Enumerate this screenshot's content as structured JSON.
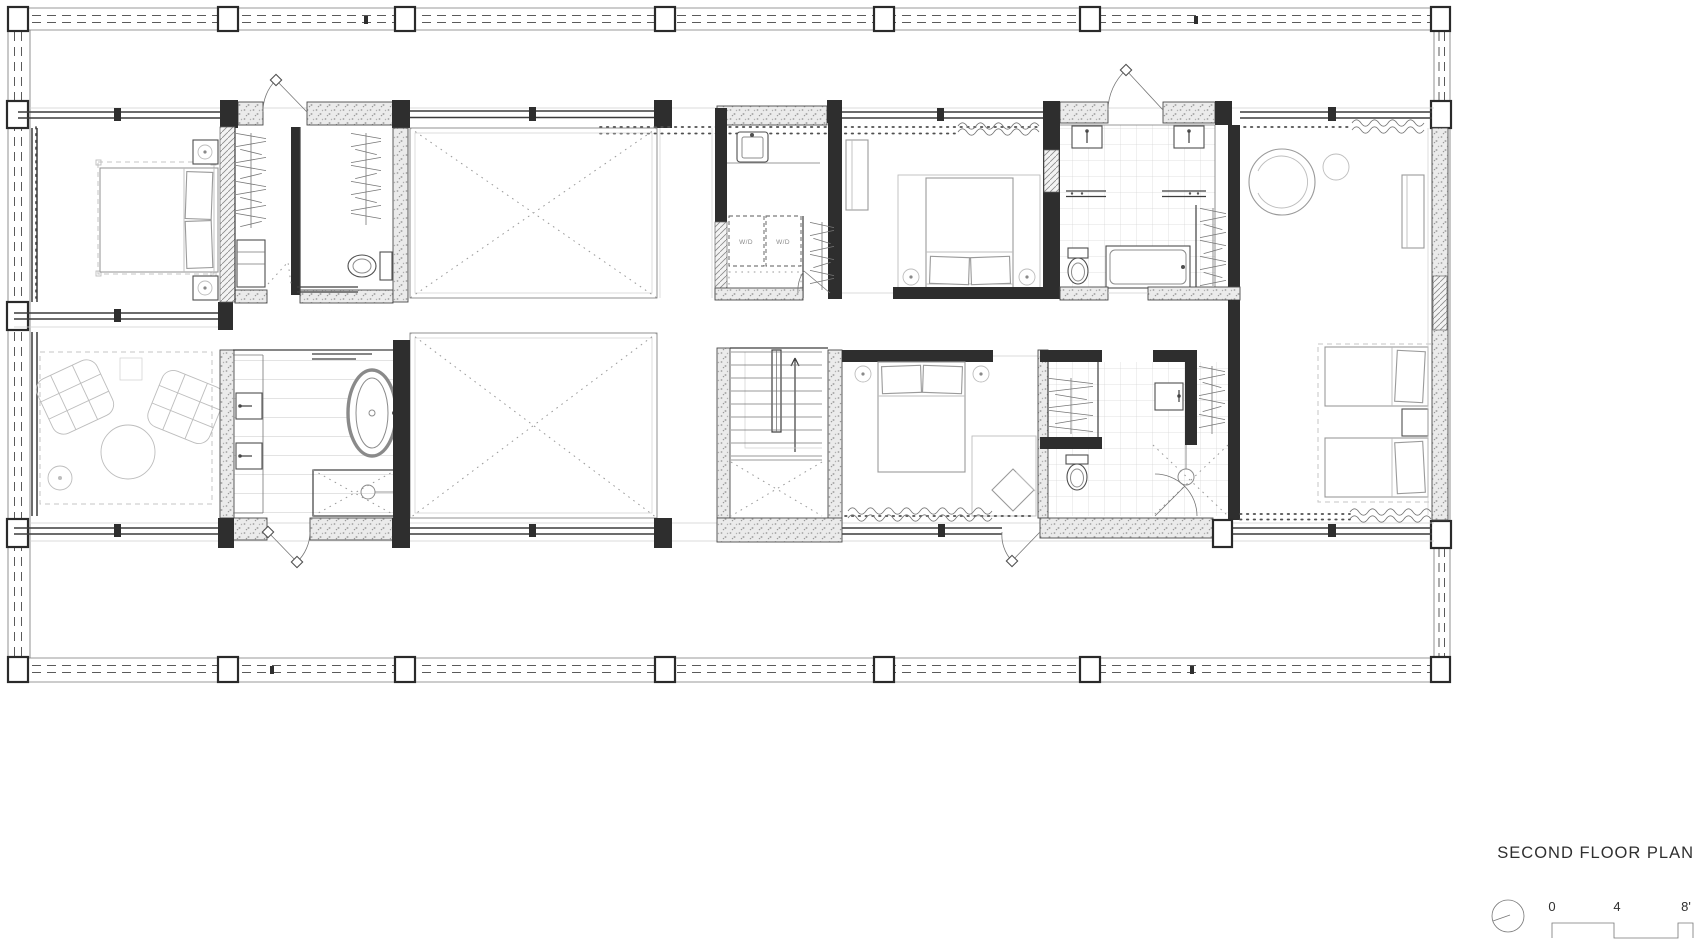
{
  "title": "SECOND FLOOR PLAN",
  "scale_bar": {
    "start": "0",
    "mid": "4",
    "end": "8'"
  },
  "laundry": {
    "appliance_label_left": "W/D",
    "appliance_label_right": "W/D"
  },
  "colors": {
    "background": "#ffffff",
    "wall_dark": "#2e2e2e",
    "wall_fill_gray": "#ebebeb",
    "line_gray": "#777777",
    "furniture_gray": "#9a9a9a",
    "text": "#2f2f2f"
  }
}
